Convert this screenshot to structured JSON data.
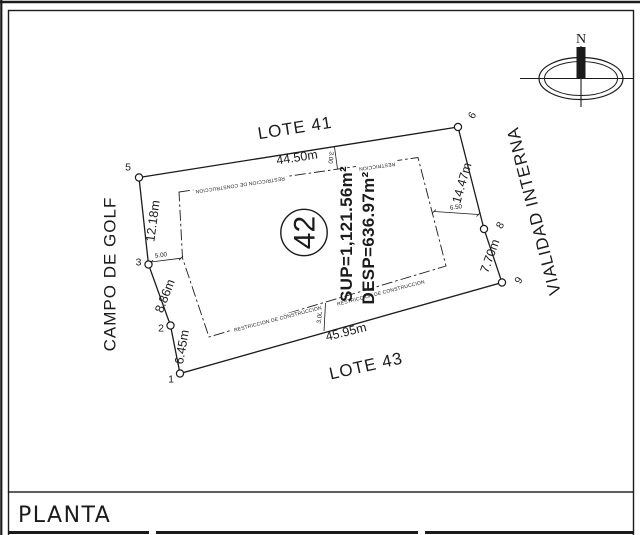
{
  "sheet": {
    "view_title": "PLANTA",
    "compass": {
      "north_label": "N"
    }
  },
  "lot": {
    "number": "42",
    "surface_area": "SUP=1,121.56m²",
    "clear_area": "DESP=636.97m²",
    "restriction_note": "RESTRICCION DE CONSTRUCCION",
    "restriction_note_word": "RESTRICCION"
  },
  "surroundings": {
    "north": "LOTE 41",
    "south": "LOTE 43",
    "west": "CAMPO DE GOLF",
    "east": "VIALIDAD INTERNA"
  },
  "dimensions": {
    "north_edge": "44.50m",
    "south_edge": "45.95m",
    "west_edge_upper": "12.18m",
    "west_edge_middle": "8.86m",
    "west_edge_lower": "6.45m",
    "east_edge_upper": "14.47m",
    "east_edge_lower": "7.70m",
    "setback_west": "5.00",
    "setback_east": "6.50",
    "setback_north": "3.00",
    "setback_south": "3.00"
  },
  "vertices": {
    "v1": "1",
    "v2": "2",
    "v3": "3",
    "v5": "5",
    "v6": "6",
    "v8": "8",
    "v9": "9"
  },
  "colors": {
    "ink": "#1b1b1b",
    "paper": "#ffffff"
  }
}
